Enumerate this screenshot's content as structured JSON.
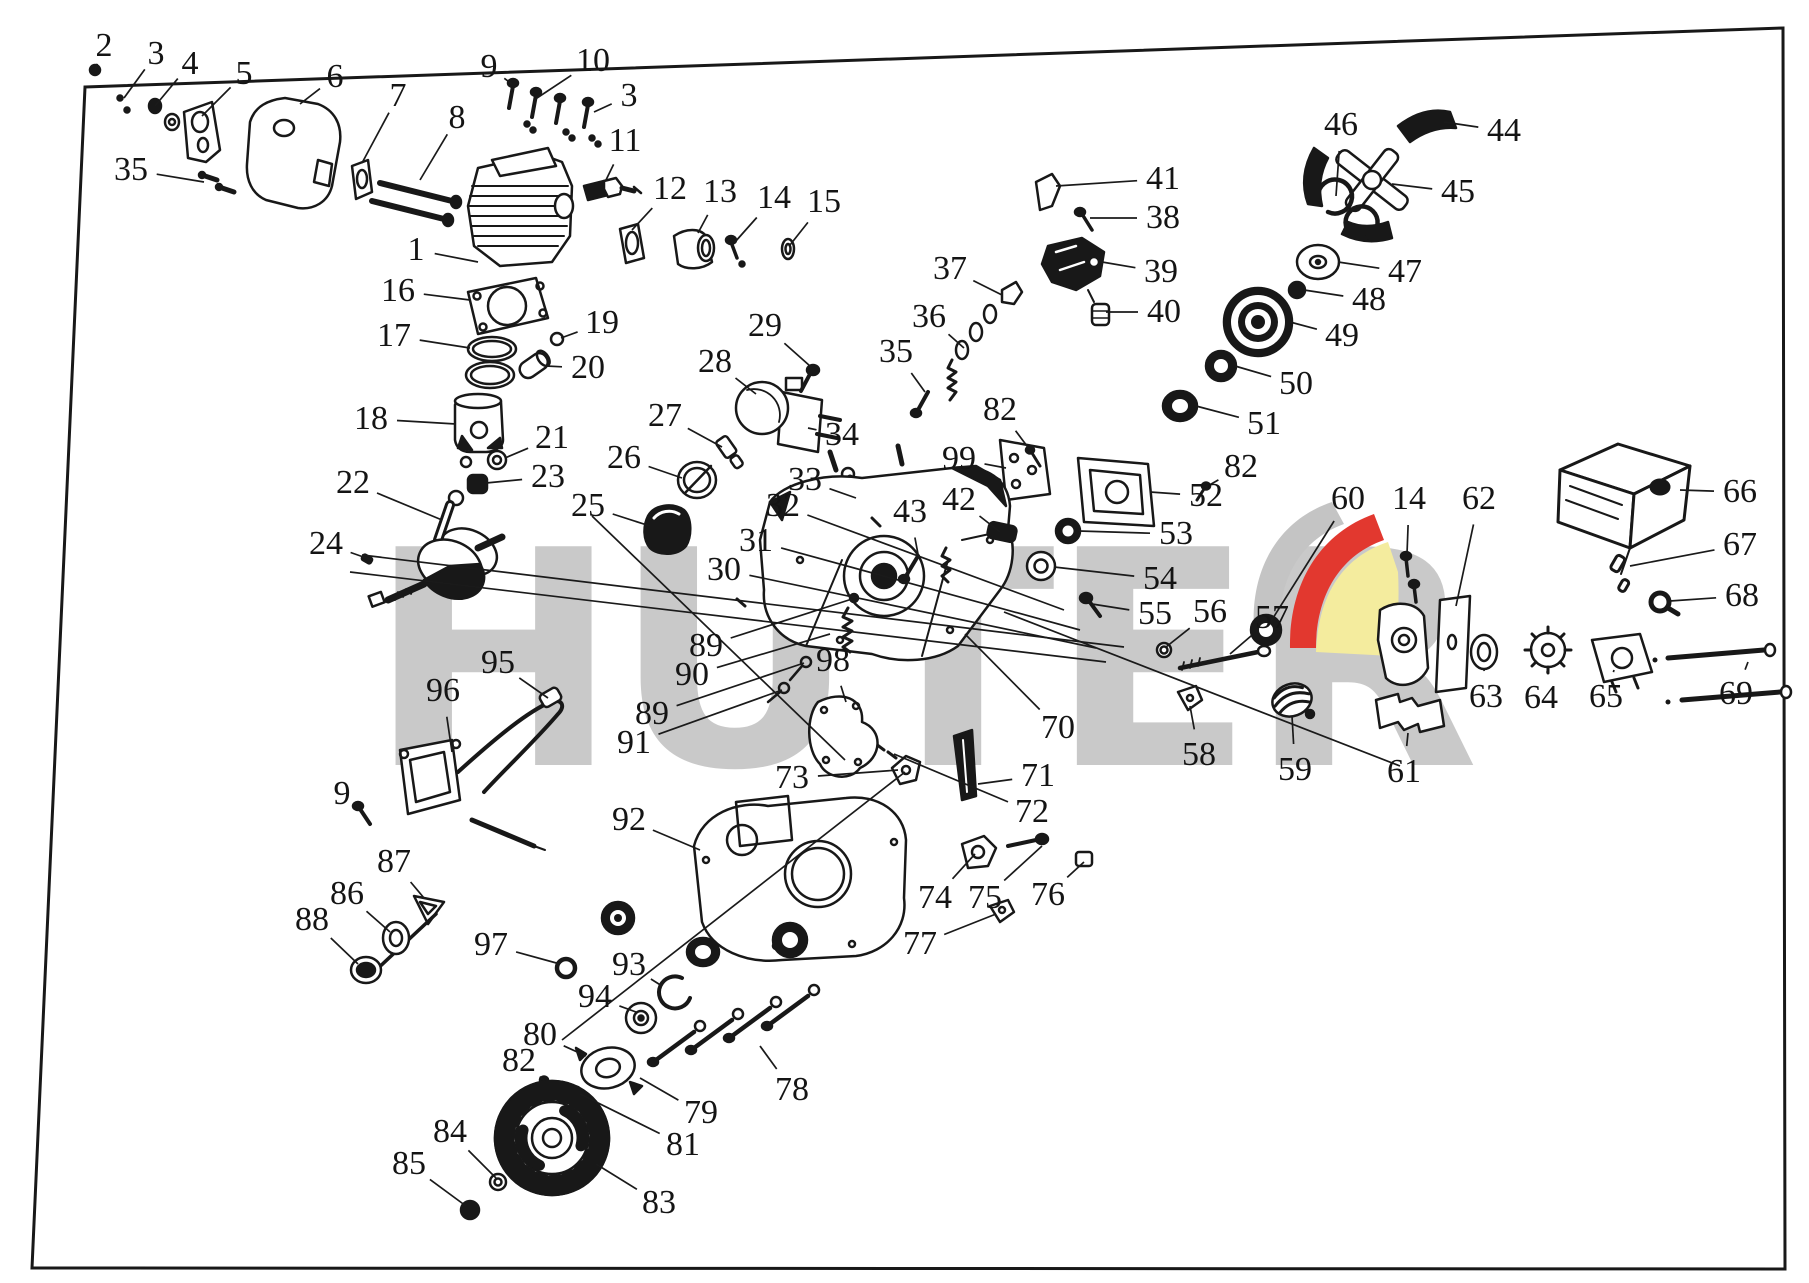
{
  "page": {
    "background": "#ffffff",
    "ink": "#181818"
  },
  "watermark": {
    "text": "HUTER",
    "color": "#c9c9c9"
  },
  "logo": {
    "gray": "#c4c4c4",
    "red": "#e2382f",
    "yellow": "#f4ec9e"
  },
  "frame": {
    "corners": "85,87 1783,28 1785,1269 32,1268",
    "stroke_width": 3
  },
  "labels": [
    {
      "n": "2",
      "x": 104,
      "y": 46,
      "tx": 95,
      "ty": 70
    },
    {
      "n": "3",
      "x": 156,
      "y": 54,
      "tx": 124,
      "ty": 98
    },
    {
      "n": "4",
      "x": 190,
      "y": 64,
      "tx": 155,
      "ty": 106
    },
    {
      "n": "5",
      "x": 244,
      "y": 74,
      "tx": 202,
      "ty": 116
    },
    {
      "n": "6",
      "x": 335,
      "y": 77,
      "tx": 300,
      "ty": 104
    },
    {
      "n": "7",
      "x": 398,
      "y": 96,
      "tx": 362,
      "ty": 163
    },
    {
      "n": "8",
      "x": 457,
      "y": 118,
      "tx": 420,
      "ty": 180
    },
    {
      "n": "9",
      "x": 489,
      "y": 67,
      "tx": 512,
      "ty": 84
    },
    {
      "n": "10",
      "x": 593,
      "y": 61,
      "tx": 534,
      "ty": 100
    },
    {
      "n": "3",
      "x": 629,
      "y": 96,
      "tx": 594,
      "ty": 112
    },
    {
      "n": "11",
      "x": 625,
      "y": 141,
      "tx": 606,
      "ty": 180
    },
    {
      "n": "35",
      "x": 131,
      "y": 170,
      "tx": 204,
      "ty": 182
    },
    {
      "n": "12",
      "x": 670,
      "y": 189,
      "tx": 632,
      "ty": 230
    },
    {
      "n": "13",
      "x": 720,
      "y": 192,
      "tx": 698,
      "ty": 233
    },
    {
      "n": "14",
      "x": 774,
      "y": 198,
      "tx": 735,
      "ty": 242
    },
    {
      "n": "15",
      "x": 824,
      "y": 202,
      "tx": 790,
      "ty": 245
    },
    {
      "n": "1",
      "x": 416,
      "y": 250,
      "tx": 478,
      "ty": 262
    },
    {
      "n": "16",
      "x": 398,
      "y": 291,
      "tx": 470,
      "ty": 300
    },
    {
      "n": "17",
      "x": 394,
      "y": 336,
      "tx": 470,
      "ty": 348
    },
    {
      "n": "19",
      "x": 602,
      "y": 323,
      "tx": 561,
      "ty": 338
    },
    {
      "n": "20",
      "x": 588,
      "y": 368,
      "tx": 546,
      "ty": 366
    },
    {
      "n": "18",
      "x": 371,
      "y": 419,
      "tx": 456,
      "ty": 424
    },
    {
      "n": "21",
      "x": 552,
      "y": 438,
      "tx": 505,
      "ty": 458
    },
    {
      "n": "23",
      "x": 548,
      "y": 477,
      "tx": 486,
      "ty": 483
    },
    {
      "n": "22",
      "x": 353,
      "y": 483,
      "tx": 442,
      "ty": 520
    },
    {
      "n": "24",
      "x": 326,
      "y": 544,
      "tx": 372,
      "ty": 560
    },
    {
      "n": "25",
      "x": 588,
      "y": 506,
      "tx": 650,
      "ty": 526
    },
    {
      "n": "26",
      "x": 624,
      "y": 458,
      "tx": 682,
      "ty": 478
    },
    {
      "n": "27",
      "x": 665,
      "y": 416,
      "tx": 722,
      "ty": 447
    },
    {
      "n": "28",
      "x": 715,
      "y": 362,
      "tx": 756,
      "ty": 394
    },
    {
      "n": "29",
      "x": 765,
      "y": 326,
      "tx": 810,
      "ty": 366
    },
    {
      "n": "34",
      "x": 842,
      "y": 435,
      "tx": 808,
      "ty": 428
    },
    {
      "n": "33",
      "x": 805,
      "y": 480,
      "tx": 856,
      "ty": 498
    },
    {
      "n": "32",
      "x": 783,
      "y": 506,
      "tx": 1064,
      "ty": 610
    },
    {
      "n": "31",
      "x": 756,
      "y": 541,
      "tx": 1080,
      "ty": 630
    },
    {
      "n": "30",
      "x": 724,
      "y": 570,
      "tx": 1096,
      "ty": 648
    },
    {
      "n": "35",
      "x": 896,
      "y": 352,
      "tx": 925,
      "ty": 392
    },
    {
      "n": "36",
      "x": 929,
      "y": 317,
      "tx": 964,
      "ty": 348
    },
    {
      "n": "37",
      "x": 950,
      "y": 269,
      "tx": 1002,
      "ty": 295
    },
    {
      "n": "41",
      "x": 1163,
      "y": 179,
      "tx": 1056,
      "ty": 186
    },
    {
      "n": "38",
      "x": 1163,
      "y": 218,
      "tx": 1090,
      "ty": 218
    },
    {
      "n": "39",
      "x": 1161,
      "y": 272,
      "tx": 1102,
      "ty": 262
    },
    {
      "n": "40",
      "x": 1164,
      "y": 312,
      "tx": 1106,
      "ty": 312
    },
    {
      "n": "46",
      "x": 1341,
      "y": 125,
      "tx": 1336,
      "ty": 196
    },
    {
      "n": "44",
      "x": 1504,
      "y": 131,
      "tx": 1444,
      "ty": 122
    },
    {
      "n": "45",
      "x": 1458,
      "y": 192,
      "tx": 1392,
      "ty": 184
    },
    {
      "n": "47",
      "x": 1405,
      "y": 272,
      "tx": 1338,
      "ty": 262
    },
    {
      "n": "48",
      "x": 1369,
      "y": 300,
      "tx": 1304,
      "ty": 290
    },
    {
      "n": "49",
      "x": 1342,
      "y": 336,
      "tx": 1290,
      "ty": 322
    },
    {
      "n": "50",
      "x": 1296,
      "y": 384,
      "tx": 1235,
      "ty": 366
    },
    {
      "n": "51",
      "x": 1264,
      "y": 424,
      "tx": 1196,
      "ty": 406
    },
    {
      "n": "82",
      "x": 1000,
      "y": 410,
      "tx": 1030,
      "ty": 450
    },
    {
      "n": "99",
      "x": 959,
      "y": 459,
      "tx": 1006,
      "ty": 468
    },
    {
      "n": "82",
      "x": 1241,
      "y": 467,
      "tx": 1206,
      "ty": 487
    },
    {
      "n": "52",
      "x": 1206,
      "y": 496,
      "tx": 1150,
      "ty": 492
    },
    {
      "n": "53",
      "x": 1176,
      "y": 534,
      "tx": 1079,
      "ty": 531
    },
    {
      "n": "54",
      "x": 1160,
      "y": 579,
      "tx": 1054,
      "ty": 567
    },
    {
      "n": "55",
      "x": 1155,
      "y": 614,
      "tx": 1092,
      "ty": 604
    },
    {
      "n": "56",
      "x": 1210,
      "y": 612,
      "tx": 1166,
      "ty": 647
    },
    {
      "n": "57",
      "x": 1272,
      "y": 618,
      "tx": 1230,
      "ty": 654
    },
    {
      "n": "42",
      "x": 959,
      "y": 500,
      "tx": 1000,
      "ty": 532
    },
    {
      "n": "43",
      "x": 910,
      "y": 512,
      "tx": 918,
      "ty": 554
    },
    {
      "n": "60",
      "x": 1348,
      "y": 499,
      "tx": 1268,
      "ty": 626
    },
    {
      "n": "14",
      "x": 1409,
      "y": 499,
      "tx": 1407,
      "ty": 554
    },
    {
      "n": "62",
      "x": 1479,
      "y": 499,
      "tx": 1456,
      "ty": 606
    },
    {
      "n": "66",
      "x": 1740,
      "y": 492,
      "tx": 1680,
      "ty": 490
    },
    {
      "n": "67",
      "x": 1740,
      "y": 545,
      "tx": 1630,
      "ty": 566
    },
    {
      "n": "68",
      "x": 1742,
      "y": 596,
      "tx": 1670,
      "ty": 601
    },
    {
      "n": "69",
      "x": 1736,
      "y": 694,
      "tx": 1748,
      "ty": 662
    },
    {
      "n": "63",
      "x": 1486,
      "y": 697,
      "tx": 1484,
      "ty": 670
    },
    {
      "n": "64",
      "x": 1541,
      "y": 698,
      "tx": 1548,
      "ty": 668
    },
    {
      "n": "65",
      "x": 1606,
      "y": 697,
      "tx": 1614,
      "ty": 670
    },
    {
      "n": "61",
      "x": 1404,
      "y": 772,
      "tx": 1408,
      "ty": 733
    },
    {
      "n": "59",
      "x": 1295,
      "y": 770,
      "tx": 1292,
      "ty": 716
    },
    {
      "n": "58",
      "x": 1199,
      "y": 755,
      "tx": 1190,
      "ty": 706
    },
    {
      "n": "70",
      "x": 1058,
      "y": 728,
      "tx": 965,
      "ty": 634
    },
    {
      "n": "71",
      "x": 1038,
      "y": 776,
      "tx": 978,
      "ty": 784
    },
    {
      "n": "72",
      "x": 1032,
      "y": 812,
      "tx": 894,
      "ty": 754
    },
    {
      "n": "73",
      "x": 792,
      "y": 778,
      "tx": 898,
      "ty": 770
    },
    {
      "n": "89",
      "x": 706,
      "y": 646,
      "tx": 852,
      "ty": 599
    },
    {
      "n": "90",
      "x": 692,
      "y": 675,
      "tx": 830,
      "ty": 634
    },
    {
      "n": "89",
      "x": 652,
      "y": 714,
      "tx": 804,
      "ty": 663
    },
    {
      "n": "91",
      "x": 634,
      "y": 743,
      "tx": 782,
      "ty": 690
    },
    {
      "n": "98",
      "x": 833,
      "y": 661,
      "tx": 846,
      "ty": 702
    },
    {
      "n": "95",
      "x": 498,
      "y": 663,
      "tx": 548,
      "ty": 698
    },
    {
      "n": "96",
      "x": 443,
      "y": 691,
      "tx": 452,
      "ty": 752
    },
    {
      "n": "9",
      "x": 342,
      "y": 794,
      "tx": 360,
      "ty": 808
    },
    {
      "n": "87",
      "x": 394,
      "y": 862,
      "tx": 424,
      "ty": 898
    },
    {
      "n": "86",
      "x": 347,
      "y": 894,
      "tx": 390,
      "ty": 932
    },
    {
      "n": "88",
      "x": 312,
      "y": 920,
      "tx": 358,
      "ty": 964
    },
    {
      "n": "92",
      "x": 629,
      "y": 820,
      "tx": 700,
      "ty": 850
    },
    {
      "n": "97",
      "x": 491,
      "y": 945,
      "tx": 560,
      "ty": 964
    },
    {
      "n": "93",
      "x": 629,
      "y": 965,
      "tx": 662,
      "ty": 986
    },
    {
      "n": "94",
      "x": 595,
      "y": 997,
      "tx": 636,
      "ty": 1012
    },
    {
      "n": "74",
      "x": 935,
      "y": 898,
      "tx": 975,
      "ty": 854
    },
    {
      "n": "75",
      "x": 985,
      "y": 898,
      "tx": 1042,
      "ty": 846
    },
    {
      "n": "76",
      "x": 1048,
      "y": 895,
      "tx": 1084,
      "ty": 862
    },
    {
      "n": "77",
      "x": 920,
      "y": 944,
      "tx": 996,
      "ty": 914
    },
    {
      "n": "80",
      "x": 540,
      "y": 1035,
      "tx": 586,
      "ty": 1056
    },
    {
      "n": "82",
      "x": 519,
      "y": 1061,
      "tx": 544,
      "ty": 1080
    },
    {
      "n": "78",
      "x": 792,
      "y": 1090,
      "tx": 760,
      "ty": 1046
    },
    {
      "n": "79",
      "x": 701,
      "y": 1113,
      "tx": 640,
      "ty": 1078
    },
    {
      "n": "81",
      "x": 683,
      "y": 1145,
      "tx": 580,
      "ty": 1094
    },
    {
      "n": "84",
      "x": 450,
      "y": 1132,
      "tx": 496,
      "ty": 1178
    },
    {
      "n": "85",
      "x": 409,
      "y": 1164,
      "tx": 466,
      "ty": 1206
    },
    {
      "n": "83",
      "x": 659,
      "y": 1203,
      "tx": 596,
      "ty": 1164
    }
  ],
  "long_lines": [
    [
      362,
      555,
      1124,
      647
    ],
    [
      350,
      572,
      1106,
      662
    ],
    [
      592,
      516,
      845,
      760
    ],
    [
      905,
      772,
      562,
      1040
    ],
    [
      1004,
      612,
      1400,
      766
    ]
  ]
}
